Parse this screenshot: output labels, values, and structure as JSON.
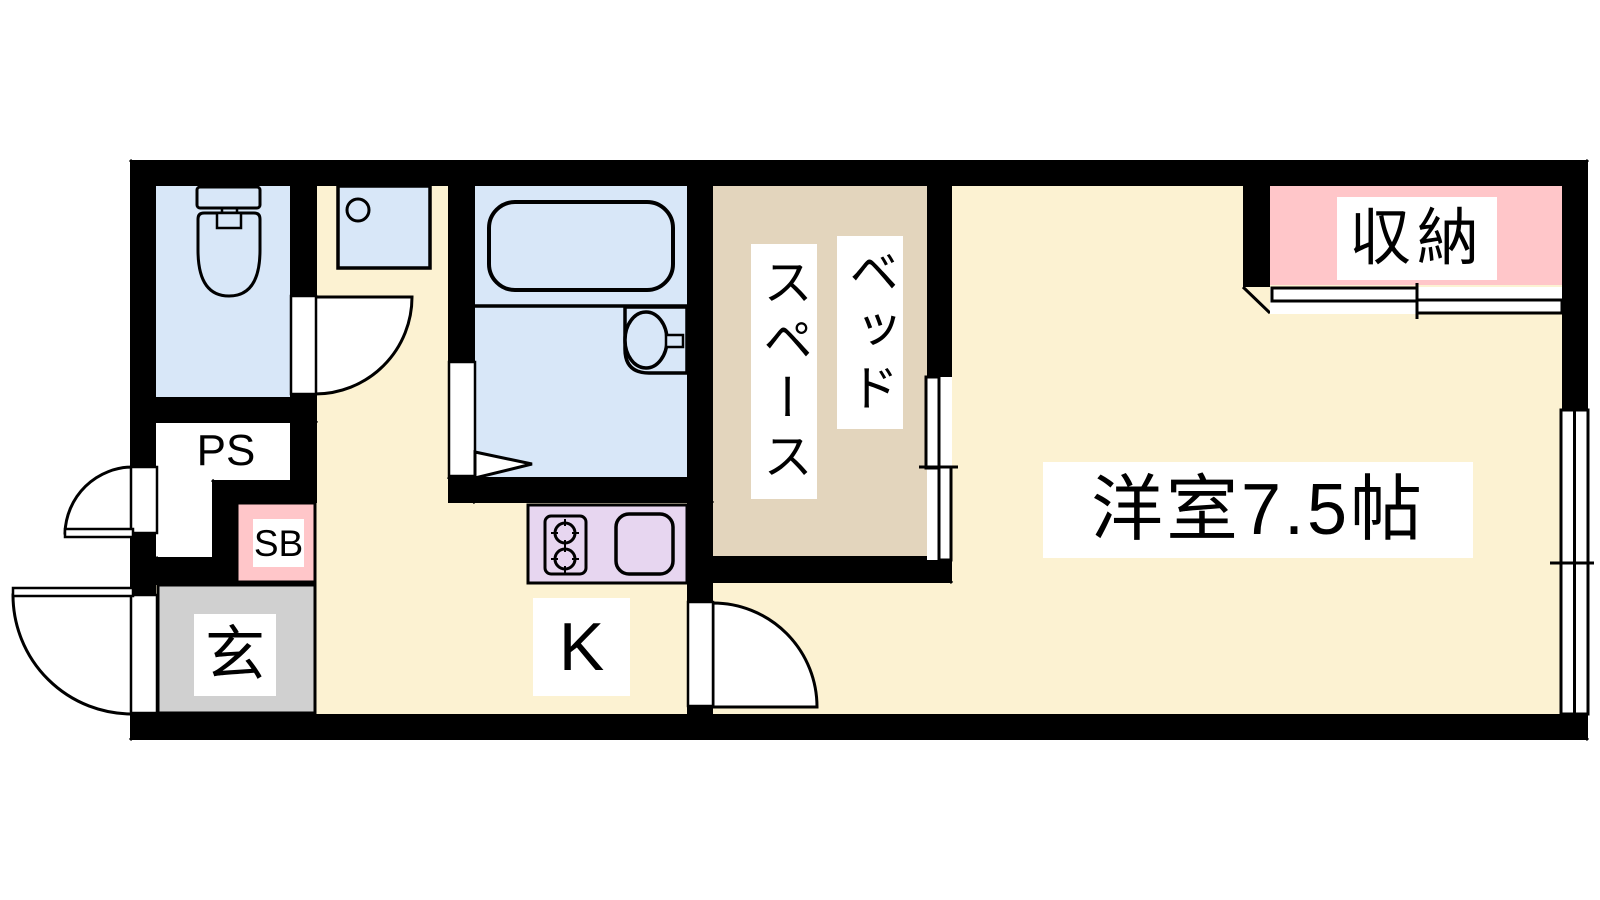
{
  "floor_plan": {
    "rooms": {
      "main_room": {
        "label": "洋室7.5帖",
        "color": "#fcf2d2"
      },
      "bed_space": {
        "label_column_right": "ベッド",
        "label_column_left": "スペース",
        "color": "#e3d5bd"
      },
      "storage": {
        "label": "収納",
        "color": "#ffc6c9"
      },
      "kitchen": {
        "label": "K",
        "counter_color": "#e7d6f0"
      },
      "entrance": {
        "label": "玄",
        "color": "#d0d0d0"
      },
      "pipe_space": {
        "label": "PS",
        "color": "#ffffff"
      },
      "shoe_box": {
        "label": "SB",
        "color": "#ffc6c9"
      },
      "toilet": {
        "color": "#d8e7f8"
      },
      "bathroom": {
        "color": "#d8e7f8"
      },
      "washbasin": {
        "color": "#d8e7f8"
      }
    },
    "wall_color": "#000000",
    "background_color": "#ffffff"
  }
}
